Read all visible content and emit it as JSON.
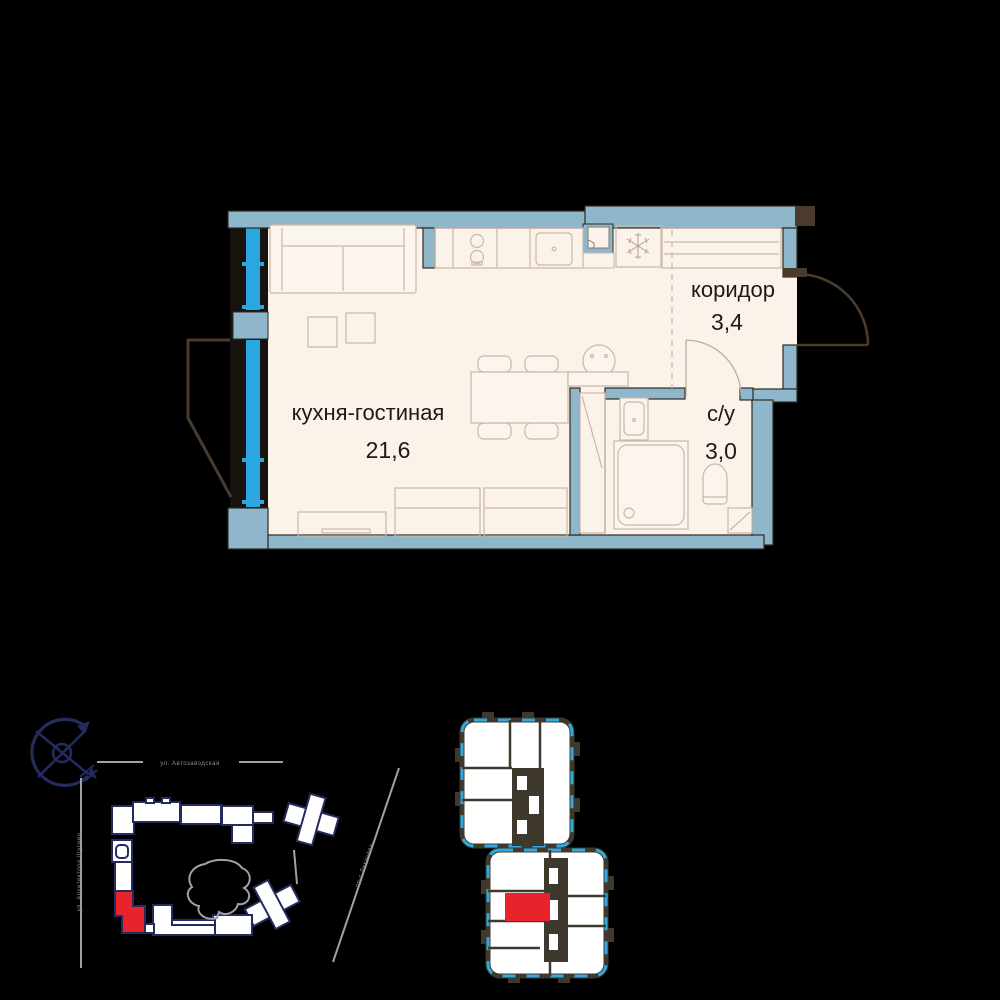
{
  "apartment_plan": {
    "rooms": [
      {
        "name": "кухня-гостиная",
        "area": "21,6"
      },
      {
        "name": "коридор",
        "area": "3,4"
      },
      {
        "name": "с/у",
        "area": "3,0"
      }
    ],
    "colors": {
      "wall": "#8FB7CB",
      "glazing": "#2AA7E0",
      "floor": "#FBF2EA",
      "furniture_outline": "#C9B8A6",
      "wall_outline": "#2E2A24",
      "door": "#4A3B2C",
      "text": "#1C1A17"
    }
  },
  "site_plan": {
    "streets": {
      "top": "ул. Автозаводская",
      "left": "ул. Архитектора Щусева",
      "right": "пр-т Лихачёва"
    },
    "colors": {
      "building_outline": "#242C5F",
      "building_fill": "#FFFFFF",
      "street_line": "#9EA0AB",
      "highlight": "#E8232B"
    },
    "icons": [
      "compass"
    ]
  },
  "floor_layout": {
    "colors": {
      "wall": "#3F382D",
      "glazing": "#2FA9E1",
      "unit_fill": "#FFFFFF",
      "highlight": "#E8232B"
    }
  }
}
